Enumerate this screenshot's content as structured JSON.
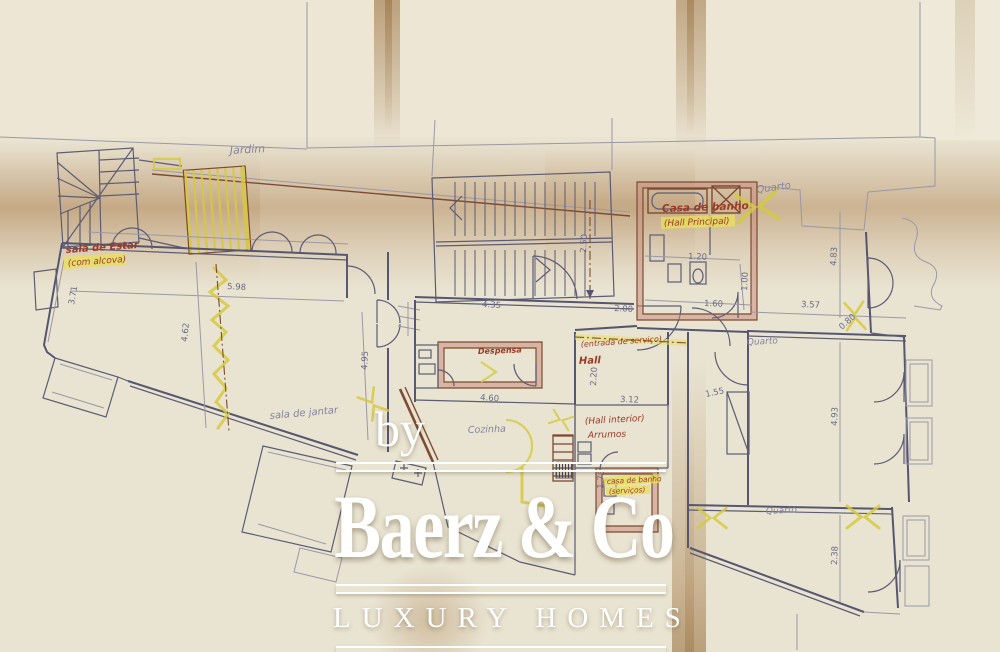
{
  "watermark": {
    "byline": "by",
    "brand": "Baerz & Co",
    "tagline": "LUXURY HOMES"
  },
  "plan": {
    "labels": {
      "jardim": "Jardim",
      "sala_estar": "sala de Estar",
      "sala_estar_sub": "(com alcova)",
      "sala_jantar": "sala de jantar",
      "despensa": "Despensa",
      "cozinha": "Cozinha",
      "entrada_servico": "(entrada de serviço)",
      "hall": "Hall",
      "hall_interior": "(Hall interior)",
      "arrumos": "Arrumos",
      "casa_banho": "Casa de banho",
      "casa_banho_sub": "(Hall Principal)",
      "casa_banho_serv": "casa de banho",
      "casa_banho_serv_sub": "(serviços)",
      "quarto_ne": "Quarto",
      "quarto_e": "Quarto",
      "quarto_se": "Quarto"
    },
    "dimensions": [
      "5.98",
      "4.62",
      "3.71",
      "4.95",
      "4.35",
      "2.50",
      "2.00",
      "3.12",
      "2.20",
      "4.60",
      "1.75",
      "1.20",
      "1.00",
      "1.60",
      "3.57",
      "4.83",
      "4.93",
      "1.55",
      "2.38",
      "0.80"
    ]
  },
  "colors": {
    "paper": "#e9e3d1",
    "fold_brown": "#a3713c",
    "ink": "#5c5c74",
    "pencil": "#9b98a6",
    "wall_brown": "#7d4b31",
    "wall_pink": "#c98e80",
    "highlight_yellow": "#d5c93f",
    "label_red": "#9c3a26",
    "watermark": "#ffffff"
  }
}
